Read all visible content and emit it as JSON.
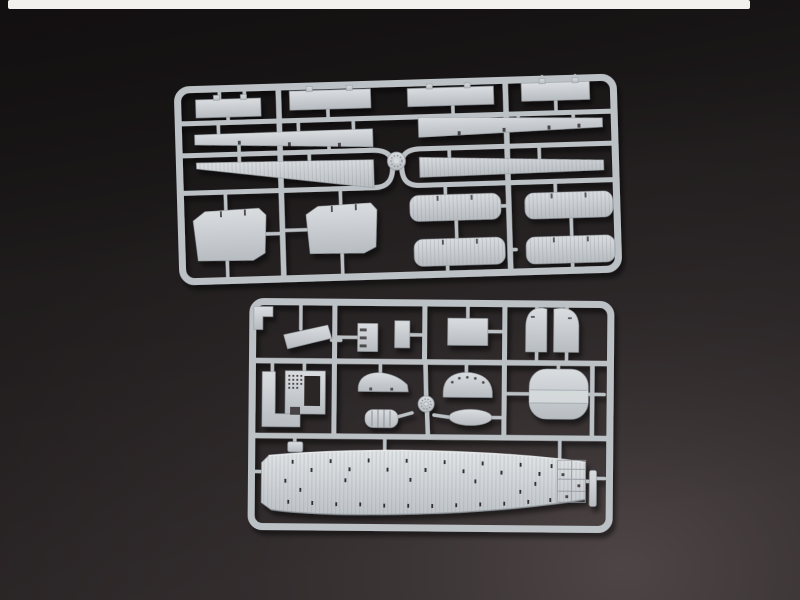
{
  "meta": {
    "description": "Product photograph of two light-gray injection-molded plastic model kit sprues (parts frames) for a warship model, lying on a dark charcoal backdrop with a bright white light strip along the top edge."
  },
  "colors": {
    "backdrop_base": "#2a2526",
    "backdrop_corner_light": "#4e4546",
    "backdrop_top_shade": "#0f0c0d",
    "strip_white": "#f2f1ee",
    "plastic_light": "#dadde0",
    "plastic_base": "#b7bcc1",
    "plastic_runner": "#bcc1c5",
    "plastic_dark": "#8f969b",
    "deck_light": "#e2e5e7",
    "slot_dark": "#332e30"
  },
  "objects": {
    "light_strip": {
      "label": "white light strip along top edge"
    },
    "top_sprue": {
      "label": "sprue A — long deck strips and platform panels",
      "parts": [
        "flat strip part (x4)",
        "notched long strip (x2)",
        "tapered planked strip (x2)",
        "angular deck panel (x2)",
        "rounded planked platform (x4)"
      ],
      "gates": [
        "round center gate knob"
      ]
    },
    "bottom_sprue": {
      "label": "sprue B — flight deck and small fittings",
      "parts": [
        "L-bracket",
        "angled ramp strip",
        "stepped bulkhead",
        "small rectangle",
        "rectangular panel",
        "round-top deck half (x2)",
        "L-shaped platform",
        "perforated grate panel",
        "curved bow quarter",
        "ribbed boat",
        "holed bow quarter",
        "oval pontoon",
        "rounded stern platform",
        "long flight deck with tie-down slots",
        "small tab",
        "thin sliver part"
      ],
      "gates": [
        "round gate knob"
      ]
    }
  }
}
